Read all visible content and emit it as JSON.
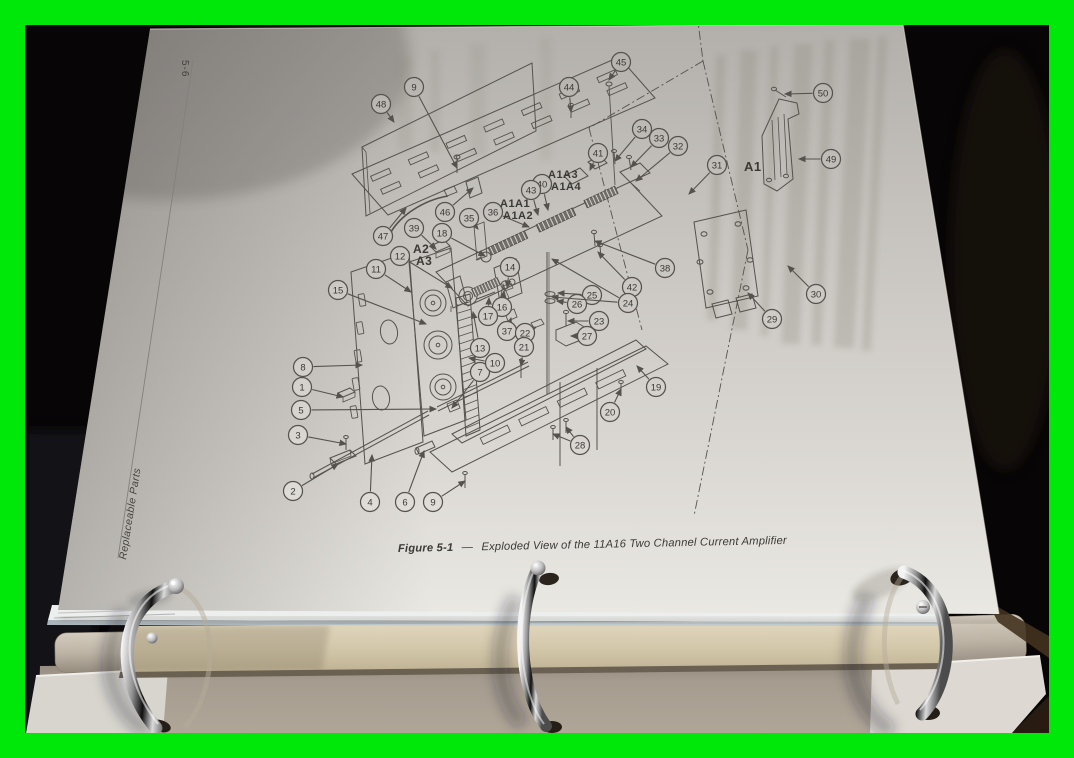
{
  "scene": {
    "border_color": "#00e70a",
    "background_color": "#070506",
    "page_color": "#d3d0cb",
    "page_number": "5-6",
    "side_label": "Replaceable Parts"
  },
  "caption": {
    "figure_label": "Figure 5-1",
    "separator": "—",
    "title": "Exploded View of the 11A16 Two Channel Current Amplifier"
  },
  "diagram": {
    "assembly_labels": [
      {
        "text": "A1",
        "x": 744,
        "y": 171,
        "size": 13
      },
      {
        "text": "A2",
        "x": 413,
        "y": 253,
        "size": 12
      },
      {
        "text": "A3",
        "x": 416,
        "y": 265,
        "size": 12
      },
      {
        "text": "A1A3",
        "x": 548,
        "y": 178,
        "size": 11
      },
      {
        "text": "A1A4",
        "x": 551,
        "y": 190,
        "size": 11
      },
      {
        "text": "A1A1",
        "x": 500,
        "y": 207,
        "size": 11
      },
      {
        "text": "A1A2",
        "x": 503,
        "y": 219,
        "size": 11
      }
    ],
    "callouts": [
      {
        "n": "48",
        "x": 381,
        "y": 104,
        "t": [
          [
            394,
            122
          ]
        ]
      },
      {
        "n": "9",
        "x": 414,
        "y": 87,
        "t": [
          [
            457,
            168
          ]
        ]
      },
      {
        "n": "44",
        "x": 569,
        "y": 87,
        "t": [
          [
            571,
            112
          ]
        ]
      },
      {
        "n": "45",
        "x": 621,
        "y": 62,
        "t": [
          [
            609,
            80
          ]
        ]
      },
      {
        "n": "50",
        "x": 823,
        "y": 93,
        "t": [
          [
            785,
            94
          ]
        ]
      },
      {
        "n": "49",
        "x": 831,
        "y": 159,
        "t": [
          [
            799,
            159
          ]
        ]
      },
      {
        "n": "34",
        "x": 642,
        "y": 129,
        "t": [
          [
            615,
            161
          ]
        ]
      },
      {
        "n": "33",
        "x": 659,
        "y": 138,
        "t": [
          [
            631,
            167
          ]
        ]
      },
      {
        "n": "32",
        "x": 678,
        "y": 146,
        "t": [
          [
            636,
            181
          ]
        ]
      },
      {
        "n": "31",
        "x": 717,
        "y": 165,
        "t": [
          [
            689,
            194
          ]
        ]
      },
      {
        "n": "41",
        "x": 598,
        "y": 153,
        "t": [
          [
            590,
            170
          ]
        ]
      },
      {
        "n": "40",
        "x": 542,
        "y": 184,
        "t": [
          [
            548,
            210
          ]
        ]
      },
      {
        "n": "43",
        "x": 531,
        "y": 190,
        "t": [
          [
            538,
            215
          ]
        ]
      },
      {
        "n": "46",
        "x": 445,
        "y": 212,
        "t": [
          [
            473,
            188
          ]
        ]
      },
      {
        "n": "47",
        "x": 383,
        "y": 236,
        "t": [
          [
            406,
            208
          ]
        ]
      },
      {
        "n": "39",
        "x": 414,
        "y": 228,
        "t": [
          [
            436,
            249
          ]
        ]
      },
      {
        "n": "35",
        "x": 469,
        "y": 218,
        "t": [
          [
            478,
            229
          ]
        ]
      },
      {
        "n": "36",
        "x": 493,
        "y": 212,
        "t": [
          [
            529,
            227
          ]
        ]
      },
      {
        "n": "18",
        "x": 442,
        "y": 233,
        "t": [
          [
            485,
            256
          ]
        ]
      },
      {
        "n": "38",
        "x": 665,
        "y": 268,
        "t": [
          [
            595,
            241
          ]
        ]
      },
      {
        "n": "42",
        "x": 632,
        "y": 287,
        "t": [
          [
            598,
            252
          ]
        ]
      },
      {
        "n": "12",
        "x": 400,
        "y": 256,
        "t": [
          [
            452,
            288
          ]
        ]
      },
      {
        "n": "11",
        "x": 376,
        "y": 269,
        "t": [
          [
            411,
            292
          ]
        ]
      },
      {
        "n": "15",
        "x": 338,
        "y": 290,
        "t": [
          [
            426,
            324
          ]
        ]
      },
      {
        "n": "14",
        "x": 510,
        "y": 267,
        "t": [
          [
            507,
            287
          ]
        ]
      },
      {
        "n": "16",
        "x": 502,
        "y": 307,
        "t": [
          [
            504,
            291
          ]
        ]
      },
      {
        "n": "17",
        "x": 488,
        "y": 316,
        "t": [
          [
            489,
            298
          ]
        ]
      },
      {
        "n": "13",
        "x": 480,
        "y": 348,
        "t": [
          [
            473,
            312
          ]
        ]
      },
      {
        "n": "37",
        "x": 507,
        "y": 331,
        "t": [
          [
            511,
            318
          ]
        ]
      },
      {
        "n": "22",
        "x": 525,
        "y": 333,
        "t": [
          [
            536,
            327
          ]
        ]
      },
      {
        "n": "21",
        "x": 524,
        "y": 347,
        "t": [
          [
            521,
            366
          ]
        ]
      },
      {
        "n": "25",
        "x": 592,
        "y": 295,
        "t": [
          [
            558,
            293
          ]
        ]
      },
      {
        "n": "26",
        "x": 577,
        "y": 304,
        "t": [
          [
            557,
            301
          ]
        ]
      },
      {
        "n": "24",
        "x": 628,
        "y": 303,
        "t": [
          [
            552,
            297
          ],
          [
            552,
            259
          ]
        ]
      },
      {
        "n": "23",
        "x": 599,
        "y": 321,
        "t": [
          [
            568,
            321
          ]
        ]
      },
      {
        "n": "27",
        "x": 587,
        "y": 336,
        "t": [
          [
            571,
            336
          ]
        ]
      },
      {
        "n": "29",
        "x": 772,
        "y": 319,
        "t": [
          [
            748,
            293
          ]
        ]
      },
      {
        "n": "30",
        "x": 816,
        "y": 294,
        "t": [
          [
            788,
            266
          ]
        ]
      },
      {
        "n": "19",
        "x": 656,
        "y": 387,
        "t": [
          [
            637,
            366
          ]
        ]
      },
      {
        "n": "20",
        "x": 610,
        "y": 412,
        "t": [
          [
            621,
            389
          ]
        ]
      },
      {
        "n": "28",
        "x": 580,
        "y": 445,
        "t": [
          [
            553,
            434
          ],
          [
            566,
            427
          ]
        ]
      },
      {
        "n": "8",
        "x": 303,
        "y": 367,
        "t": [
          [
            362,
            365
          ]
        ]
      },
      {
        "n": "1",
        "x": 302,
        "y": 387,
        "t": [
          [
            343,
            397
          ]
        ]
      },
      {
        "n": "5",
        "x": 301,
        "y": 410,
        "t": [
          [
            436,
            409
          ]
        ]
      },
      {
        "n": "3",
        "x": 298,
        "y": 435,
        "t": [
          [
            346,
            444
          ]
        ]
      },
      {
        "n": "2",
        "x": 293,
        "y": 491,
        "t": [
          [
            338,
            464
          ]
        ]
      },
      {
        "n": "4",
        "x": 370,
        "y": 502,
        "t": [
          [
            372,
            455
          ]
        ]
      },
      {
        "n": "6",
        "x": 405,
        "y": 502,
        "t": [
          [
            424,
            451
          ]
        ]
      },
      {
        "n": "9",
        "x": 433,
        "y": 502,
        "t": [
          [
            465,
            481
          ]
        ]
      },
      {
        "n": "7",
        "x": 480,
        "y": 372,
        "t": [
          [
            452,
            408
          ]
        ]
      },
      {
        "n": "10",
        "x": 495,
        "y": 363,
        "t": [
          [
            469,
            358
          ]
        ]
      }
    ]
  }
}
